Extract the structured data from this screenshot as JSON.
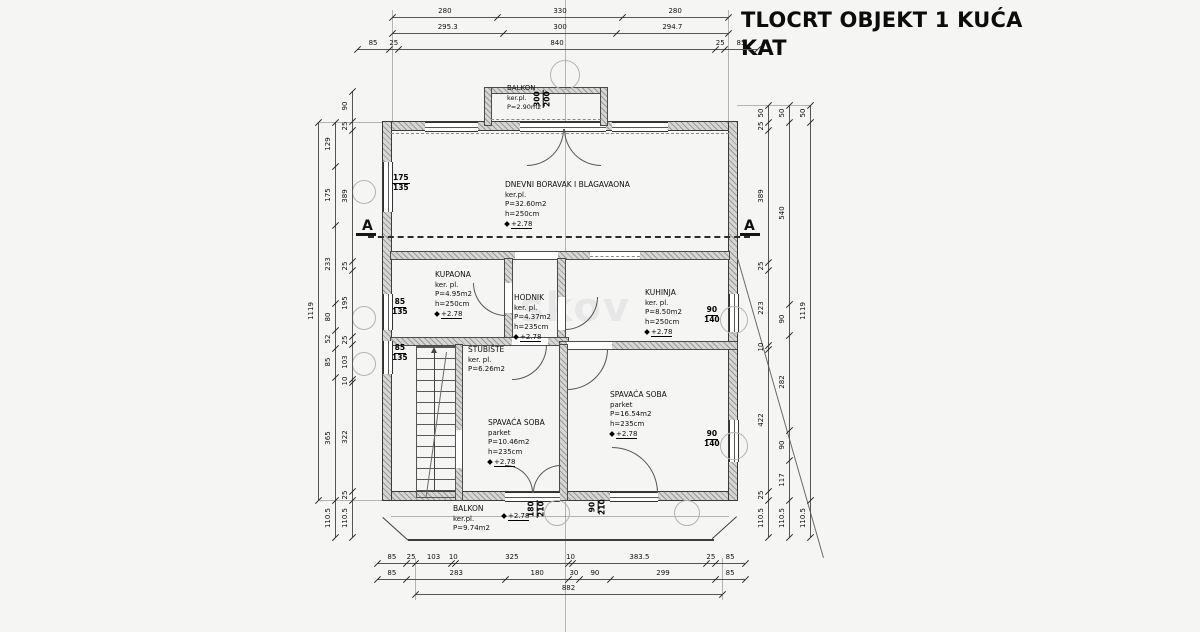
{
  "title": {
    "line1": "TLOCRT OBJEKT 1 KUĆA",
    "line2": "KAT"
  },
  "section_marker": "A",
  "watermark": "skov",
  "rooms": {
    "balkon_top": {
      "name": "BALKON",
      "floor": "ker.pl.",
      "area": "P=2.90m2"
    },
    "dnevni": {
      "name": "DNEVNI BORAVAK I BLAGAVAONA",
      "floor": "ker.pl.",
      "area": "P=32.60m2",
      "height": "h=250cm",
      "level": "+2.78"
    },
    "kupaona": {
      "name": "KUPAONA",
      "floor": "ker. pl.",
      "area": "P=4.95m2",
      "height": "h=250cm",
      "level": "+2.78"
    },
    "hodnik": {
      "name": "HODNIK",
      "floor": "ker. pl.",
      "area": "P=4.37m2",
      "height": "h=235cm",
      "level": "+2.78"
    },
    "kuhinja": {
      "name": "KUHINJA",
      "floor": "ker. pl.",
      "area": "P=8.50m2",
      "height": "h=250cm",
      "level": "+2.78"
    },
    "stubiste": {
      "name": "STUBIŠTE",
      "floor": "ker. pl.",
      "area": "P=6.26m2"
    },
    "spavaca1": {
      "name": "SPAVAĆA SOBA",
      "floor": "parket",
      "area": "P=10.46m2",
      "height": "h=235cm",
      "level": "+2.78"
    },
    "spavaca2": {
      "name": "SPAVAĆA SOBA",
      "floor": "parket",
      "area": "P=16.54m2",
      "height": "h=235cm",
      "level": "+2.78"
    },
    "balkon_bottom": {
      "name": "BALKON",
      "floor": "ker.pl.",
      "area": "P=9.74m2",
      "level": "+2.78"
    }
  },
  "openings": {
    "balcony_door_top": {
      "w": "300",
      "h": "200"
    },
    "window_left_1": {
      "w": "175",
      "h": "135"
    },
    "window_left_2": {
      "w": "85",
      "h": "135"
    },
    "window_left_3": {
      "w": "85",
      "h": "135"
    },
    "window_right_1": {
      "w": "90",
      "h": "140"
    },
    "window_right_2": {
      "w": "90",
      "h": "140"
    },
    "balcony_door_bottom_1": {
      "w": "180",
      "h": "210"
    },
    "balcony_door_bottom_2": {
      "w": "90",
      "h": "210"
    }
  },
  "dimensions": {
    "top_row1": [
      "280",
      "330",
      "280"
    ],
    "top_row2": [
      "295.3",
      "300",
      "294.7"
    ],
    "top_row3": [
      "85",
      "25",
      "840",
      "25",
      "85"
    ],
    "bottom_row1": [
      "85",
      "25",
      "103",
      "10",
      "325",
      "10",
      "383.5",
      "25",
      "85"
    ],
    "bottom_row2": [
      "85",
      "283",
      "180",
      "30",
      "90",
      "299",
      "85"
    ],
    "bottom_total": [
      "882"
    ],
    "left_outer": [
      "1119"
    ],
    "left_mid": [
      "129",
      "175",
      "233",
      "80",
      "52",
      "85",
      "365",
      "110.5"
    ],
    "left_inner": [
      "90",
      "25",
      "389",
      "25",
      "195",
      "25",
      "103",
      "10",
      "322",
      "25",
      "110.5"
    ],
    "right_inner": [
      "50",
      "25",
      "389",
      "25",
      "223",
      "10",
      "422",
      "25",
      "110.5"
    ],
    "right_mid": [
      "50",
      "540",
      "90",
      "282",
      "90",
      "117",
      "110.5"
    ],
    "right_outer": [
      "50",
      "1119",
      "110.5"
    ]
  }
}
